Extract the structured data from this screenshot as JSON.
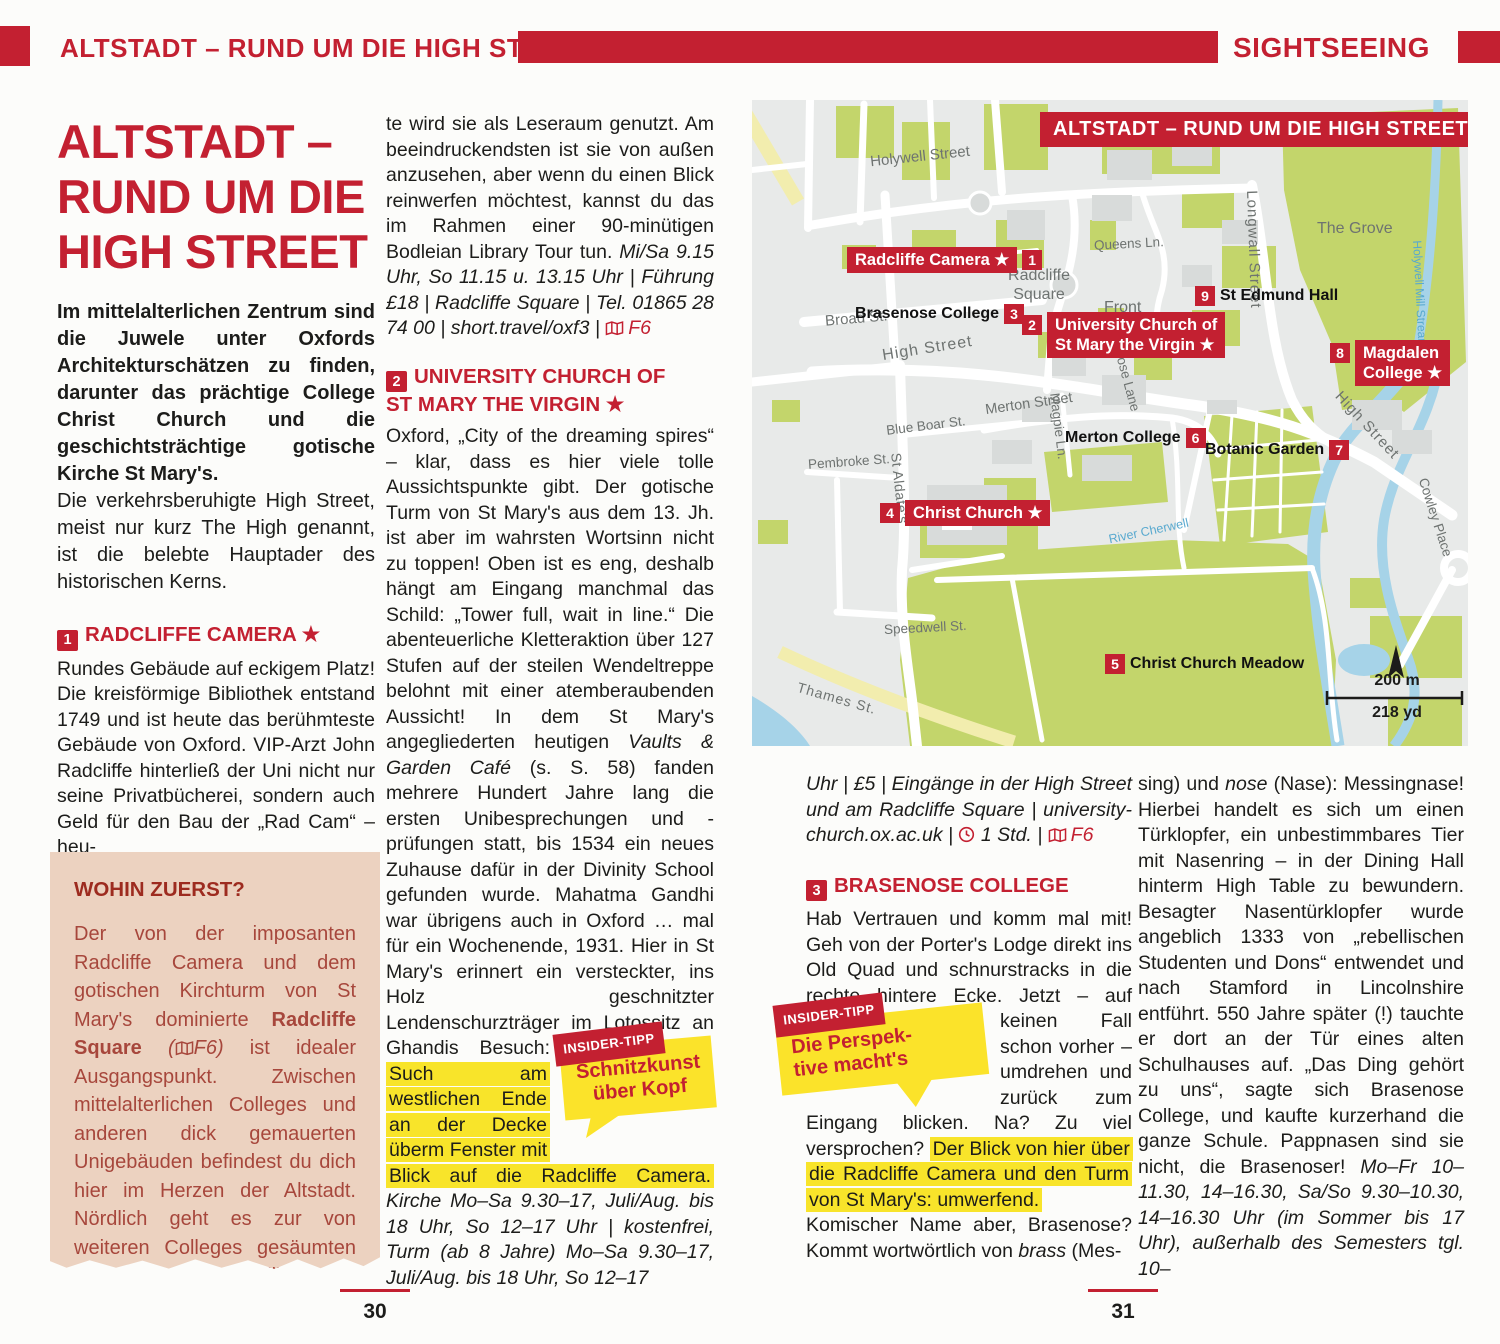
{
  "colors": {
    "accent_red": "#c32031",
    "highlight_yellow": "#f8e42a",
    "tip_yellow": "#fbe32a",
    "box_salmon": "#ecd2c0",
    "box_text_red": "#a7473c",
    "map_green": "#c3d56b",
    "map_water": "#a6d3e8",
    "map_gray": "#e8eae9"
  },
  "header": {
    "left_title": "ALTSTADT – RUND UM DIE HIGH STREET",
    "right_title": "SIGHTSEEING"
  },
  "footer": {
    "page_left": "30",
    "page_right": "31"
  },
  "article": {
    "title_line1": "ALTSTADT –",
    "title_line2": "RUND UM DIE",
    "title_line3": "HIGH STREET",
    "intro_bold": "Im mittelalterlichen Zentrum sind die Juwele unter Oxfords Architekturschätzen zu finden, darunter das prächtige College Christ Church und die geschichtsträchtige gotische Kirche St Mary's.",
    "intro_regular": "Die verkehrsberuhigte High Street, meist nur kurz The High genannt, ist die belebte Hauptader des historischen Kerns."
  },
  "sections": {
    "radcliffe": {
      "num": "1",
      "title": "RADCLIFFE CAMERA",
      "star": "★",
      "body": "Rundes Gebäude auf eckigem Platz! Die kreisförmige Bibliothek entstand 1749 und ist heute das berühmteste Gebäude von Oxford. VIP-Arzt John Radcliffe hinterließ der Uni nicht nur seine Privatbücherei, sondern auch Geld für den Bau der „Rad Cam“ – heu-"
    },
    "continuation": {
      "t1": "te wird sie als Leseraum genutzt. Am beeindruckendsten ist sie von außen anzusehen, aber wenn du einen Blick reinwerfen möchtest, kannst du das im Rahmen einer 90-minütigen Bodleian Library Tour tun. ",
      "t2": "Mi/Sa 9.15 Uhr, So 11.15 u. 13.15 Uhr | Führung £18 | Radcliffe Square | Tel. 01865 28 74 00 | short.travel/oxf3 | ",
      "map_ref": "F6"
    },
    "stmary": {
      "num": "2",
      "title_line1": "UNIVERSITY CHURCH OF",
      "title_line2": "ST MARY THE VIRGIN",
      "star": "★",
      "t1": "Oxford, „City of the dreaming spires“ – klar, dass es hier viele tolle Aussichtspunkte gibt. Der gotische Turm von St Mary's aus dem 13. Jh. ist aber im wahrsten Wortsinn nicht zu toppen! Oben ist es eng, deshalb hängt am Eingang manchmal das Schild: „Tower full, wait in line.“ Die abenteuerliche Kletteraktion über 127 Stufen auf der steilen Wendeltreppe belohnt mit einer atemberaubenden Aussicht! In dem St Mary's angegliederten heutigen ",
      "t2_italic": "Vaults & Garden Café",
      "t3": " (s. S. 58) fanden mehrere Hundert Jahre lang die ersten Unibesprechungen und -prüfungen statt, bis 1534 ein neues Zuhause dafür in der Divinity School gefunden wurde. Mahatma Gandhi war übrigens auch in Oxford … mal für ein Wochenende, 1931. Hier in St Mary's erinnert ein versteckter, ins Holz geschnitzter Lendenschurzträger im Lotossitz an Ghandis Besuch: ",
      "t4_highlight": "Such am westlichen Ende an der Decke überm Fenster mit Blick auf die Radcliffe Camera.",
      "t5_italic": " Kirche Mo–Sa 9.30–17, Juli/Aug. bis 18 Uhr, So 12–17 Uhr | kostenfrei, Turm (ab 8 Jahre) Mo–Sa 9.30–17, Juli/Aug. bis 18 Uhr, So 12–17",
      "t6_italic": "Uhr | £5 | Eingänge in der High Street und am Radcliffe Square | university-church.ox.ac.uk | ",
      "t7_italic": " 1 Std. | ",
      "map_ref": "F6"
    },
    "brasenose": {
      "num": "3",
      "title": "BRASENOSE COLLEGE",
      "t1": "Hab Vertrauen und komm mal mit! Geh von der Porter's Lodge direkt ins Old Quad und schnurstracks in die rechte hintere Ecke. Jetzt – auf keinen ",
      "t2": "Fall schon vorher – umdrehen und zurück zum Eingang blicken. Na? Zu viel versprochen? ",
      "t3_highlight": "Der Blick von hier über die Radcliffe Camera und den Turm von St Mary's: umwerfend.",
      "t4": "Komischer Name aber, Brasenose? Kommt wortwörtlich von ",
      "t5_italic": "brass",
      "t6": " (Mes-",
      "t7": "sing) und ",
      "t8_italic": "nose",
      "t9": " (Nase): Messingnase! Hierbei handelt es sich um einen Türklopfer, ein unbestimmbares Tier mit Nasenring – in der Dining Hall hinterm High Table zu bewundern. Besagter Nasentürklopfer wurde angeblich 1333 von „rebellischen Studenten und Dons“ entwendet und nach Stamford in Lincolnshire entführt. 550 Jahre später (!) tauchte er dort an der Tür eines alten Schulhauses auf. „Das Ding gehört zu uns“, sagte sich Brasenose College, und kaufte kurzerhand die ganze Schule. Pappnasen sind sie nicht, die Brasenoser! ",
      "t10_italic": "Mo–Fr 10–11.30, 14–16.30, Sa/So 9.30–10.30, 14–16.30 Uhr (im Sommer bis 17 Uhr), außerhalb des Semesters tgl. 10–"
    }
  },
  "wohin_box": {
    "title": "WOHIN ZUERST?",
    "t1": "Der von der imposanten Radcliffe Camera und dem gotischen Kirchturm von St Mary's dominierte ",
    "t2_bold": "Radcliffe Square",
    "t3_italic": " (",
    "map_ref": "F6)",
    "t4": " ist idealer Ausgangspunkt. Zwischen mittelalterlichen Colleges und anderen dick gemauerten Unigebäuden befindest du dich hier im Herzen der Altstadt. Nördlich geht es zur von weiteren Colleges gesäumten Broad Street, südlich zur historischen High Street."
  },
  "insider_tips": [
    {
      "badge": "INSIDER-TIPP",
      "line1": "Schnitzkunst",
      "line2": "über Kopf"
    },
    {
      "badge": "INSIDER-TIPP",
      "line1": "Die Perspek-",
      "line2": "tive macht's"
    }
  ],
  "map": {
    "title": "ALTSTADT – RUND UM DIE HIGH STREET",
    "streets": [
      "Holywell Street",
      "Broad St.",
      "Front Quad",
      "Queens Ln.",
      "Longwall Street",
      "The Grove",
      "Radcliffe Square",
      "High Street",
      "Magpie Ln.",
      "Merton Street",
      "Blue Boar St.",
      "Pembroke St.",
      "St Aldate's",
      "Speedwell St.",
      "Thames St.",
      "Rose Lane",
      "High Street",
      "Cowley Place",
      "River Cherwell",
      "Holywell Mill Stream"
    ],
    "sights": [
      {
        "num": "1",
        "name": "Radcliffe Camera",
        "star": "★"
      },
      {
        "num": "2",
        "name_line1": "University Church of",
        "name_line2": "St Mary the Virgin",
        "star": "★"
      },
      {
        "num": "3",
        "name": "Brasenose College"
      },
      {
        "num": "4",
        "name": "Christ Church",
        "star": "★"
      },
      {
        "num": "5",
        "name": "Christ Church Meadow"
      },
      {
        "num": "6",
        "name": "Merton College"
      },
      {
        "num": "7",
        "name": "Botanic Garden"
      },
      {
        "num": "8",
        "name_line1": "Magdalen",
        "name_line2": "College",
        "star": "★"
      },
      {
        "num": "9",
        "name": "St Edmund Hall"
      }
    ],
    "scale": {
      "metric": "200 m",
      "imperial": "218 yd"
    }
  }
}
